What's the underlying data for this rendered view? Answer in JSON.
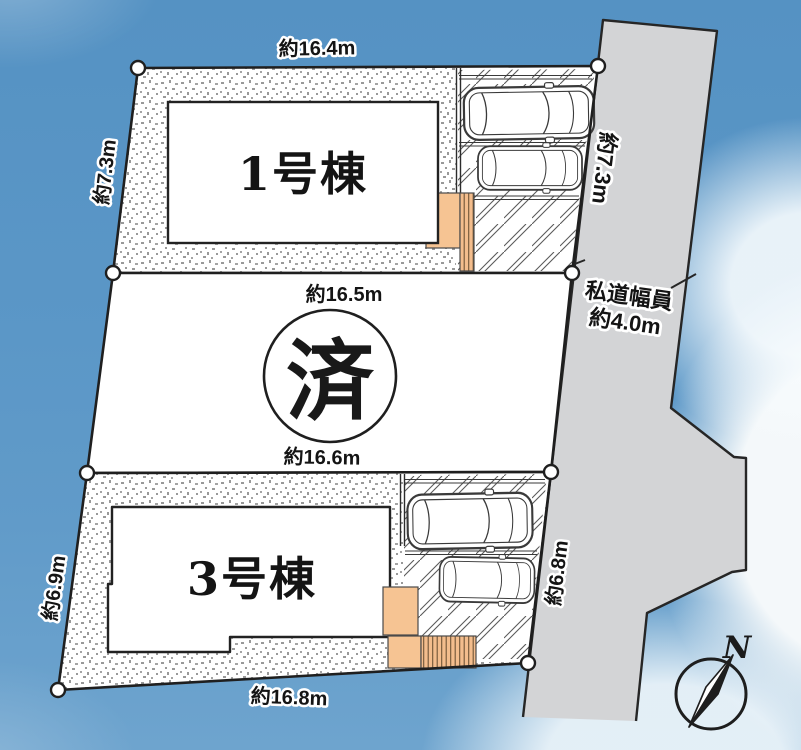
{
  "colors": {
    "sky": "#5b97c7",
    "cloud": "#f4f8fa",
    "road": "#d3d4d6",
    "lot": "#ffffff",
    "outline": "#1f1f1f",
    "stipple": "#8e8e8e",
    "porch": "#f6c493",
    "steps_stripe": "#6f5436",
    "text": "#141414",
    "text_halo": "#ffffff"
  },
  "road": {
    "side_dim": "約7.3m",
    "width_label": "私道幅員",
    "width_value": "約4.0m"
  },
  "lot1": {
    "name": "1号棟",
    "top_dim": "約16.4m",
    "left_dim": "約7.3m",
    "cars_parked": 2
  },
  "lot2": {
    "status": "済",
    "top_dim": "約16.5m",
    "bottom_dim": "約16.6m"
  },
  "lot3": {
    "name": "3号棟",
    "left_dim": "約6.9m",
    "bottom_dim": "約16.8m",
    "right_dim": "約6.8m",
    "cars_parked": 2
  },
  "compass": {
    "north_label": "N"
  },
  "icons": {
    "car": "top-view-car-outline",
    "compass_needle": "half-filled-north-needle",
    "corner_marker": "white-circle-boundary-point"
  }
}
